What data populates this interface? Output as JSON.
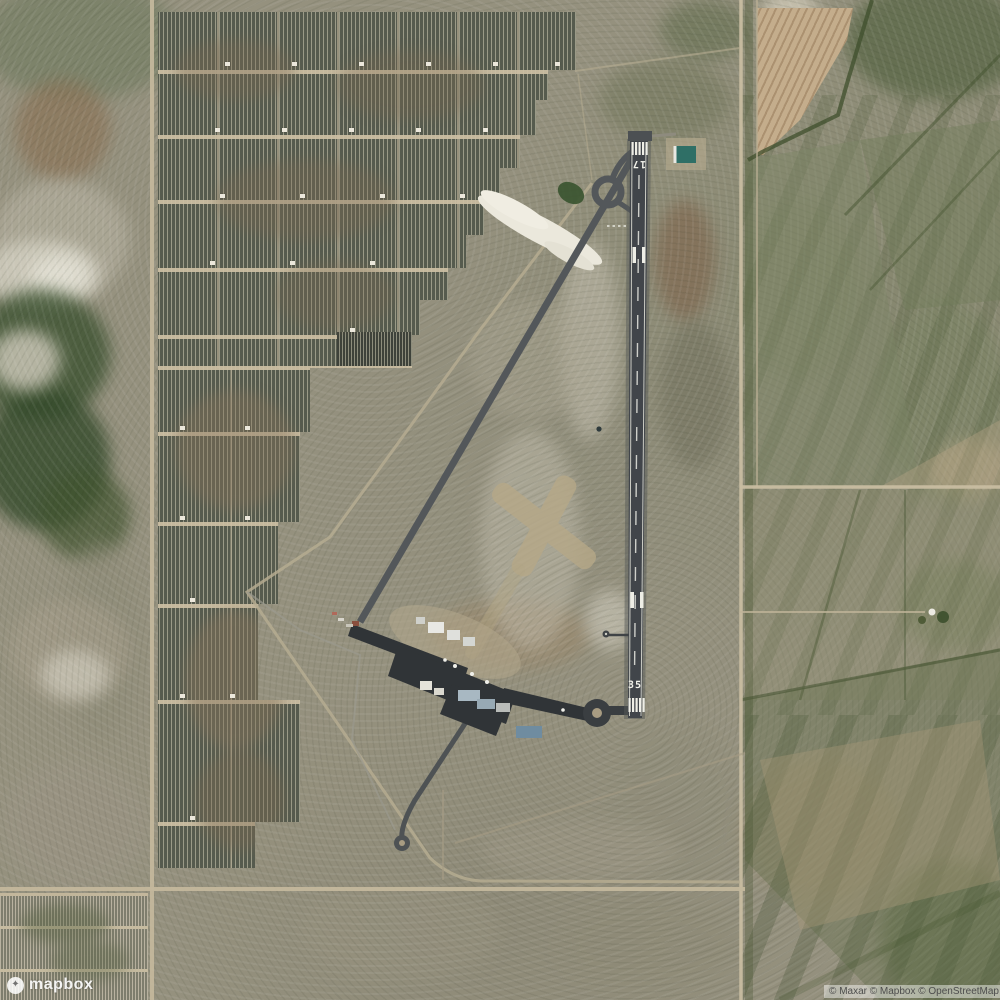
{
  "map": {
    "type": "satellite-imagery",
    "logo_text": "mapbox",
    "attribution": {
      "text": "© Maxar © Mapbox © OpenStreetMap",
      "items": [
        "© Maxar",
        "© Mapbox",
        "© OpenStreetMap"
      ]
    }
  },
  "airport": {
    "runway": {
      "north_end_label": "17",
      "south_end_label": "35"
    }
  },
  "colors": {
    "scrub_base": "#95917e",
    "runway_asphalt": "#41454a",
    "apron_asphalt": "#303437",
    "dirt_road": "#c3b79c",
    "solar_panel_dark": "#565b4e",
    "solar_panel_light": "#9a9a87",
    "vegetation_dark": "#3c4f2f",
    "plowed_field": "#c4ad8c",
    "marking_white": "#eeeee6",
    "teal_roof": "#2f6f66"
  }
}
